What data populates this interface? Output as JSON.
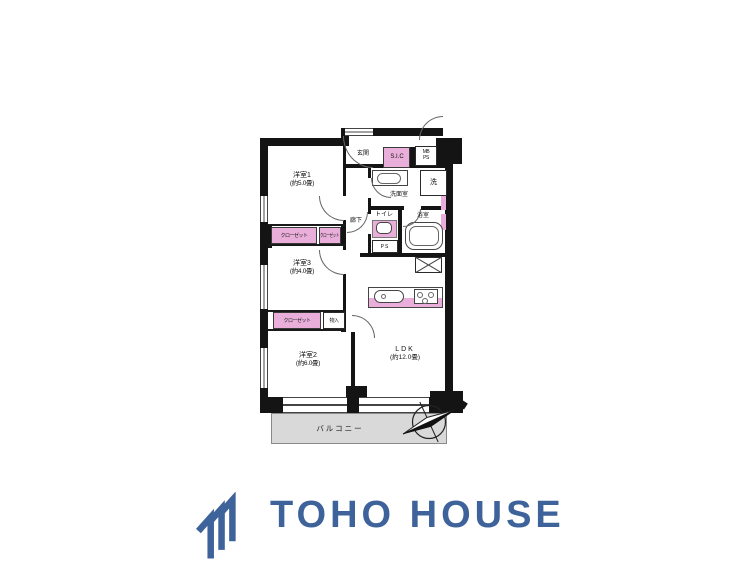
{
  "plan": {
    "rooms": {
      "room1": {
        "label": "洋室1",
        "size": "(約5.0畳)"
      },
      "room3": {
        "label": "洋室3",
        "size": "(約4.0畳)"
      },
      "room2": {
        "label": "洋室2",
        "size": "(約6.0畳)"
      },
      "ldk": {
        "label": "LDK",
        "size": "(約12.0畳)"
      }
    },
    "areas": {
      "genkan": "玄関",
      "rouka": "廊下",
      "senmenshitsu": "洗面室",
      "toire": "トイレ",
      "yokushitsu": "浴室",
      "balcony": "バルコニー"
    },
    "storage": {
      "sic": "S.I.C",
      "closet_a": "クローゼット",
      "closet_b": "クローゼット",
      "closet_c": "クローゼット",
      "monoire": "物入"
    },
    "utility": {
      "mb_ps": "MB\nPS",
      "ps": "PS",
      "washer": "洗"
    }
  },
  "branding": {
    "logo_text": "TOHO HOUSE"
  },
  "colors": {
    "accent_pink": "#e9aed9",
    "balcony_gray": "#d9d9d9",
    "wall": "#141414",
    "logo_blue": "#3e639a"
  }
}
